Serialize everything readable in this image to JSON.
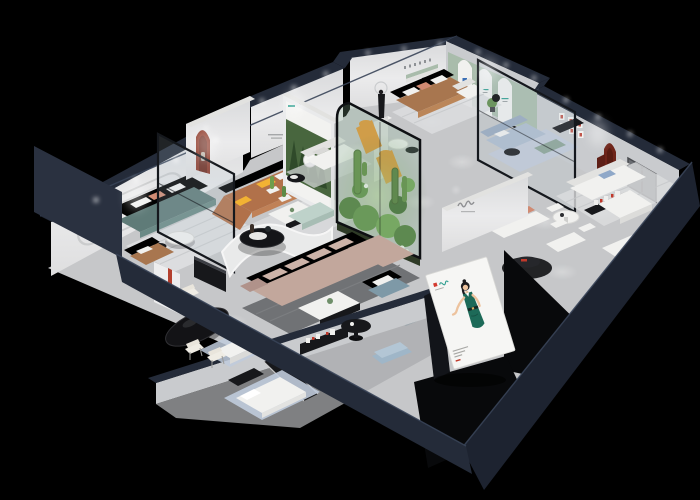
{
  "scene": {
    "kind": "isometric-cutaway-3d-floorplan",
    "subject": "furniture showroom dollhouse render on black background"
  },
  "palette": {
    "bg": "#000000",
    "navy": "#242b39",
    "navy2": "#1d2330",
    "navy3": "#2a3140",
    "face": "#e9eaeb",
    "faceShade": "#c9cbce",
    "floor": "#c6c7c9",
    "floorDark": "#a9abae",
    "rugLight": "#dcdddf",
    "rugDark": "#707275",
    "rugBlue": "#c0cbdc",
    "teal": "#5f7b78",
    "tealD": "#4f6a67",
    "cognac": "#b1714a",
    "cognacD": "#97593a",
    "leather": "#a8764f",
    "leatherD": "#8d6140",
    "rose": "#c2a79c",
    "roseD": "#b0928a",
    "white": "#f1f1ef",
    "whiteDim": "#e2e2e0",
    "bluegray": "#7e99a7",
    "bluegrayD": "#6f8fa0",
    "lightblue": "#aebccf",
    "orange": "#e8952f",
    "yellow": "#f2b233",
    "mint": "#bed2ca",
    "sage": "#a9bcab",
    "plant": "#5c8a46",
    "plantD": "#3f6a2e",
    "terr": "#6f9e4e",
    "blackF": "#17181b",
    "archRed": "#8e3a2a",
    "archDarkRed": "#6e2419",
    "redAccent": "#c0392b",
    "coral": "#d08a72",
    "glass": "rgba(185,202,212,0.18)",
    "glassGreen": "rgba(140,180,150,0.26)",
    "bbWhite": "#f6f6f4",
    "dress": "#1d6a58",
    "skin": "#edc39e",
    "hair": "#1c1b1e",
    "logoTeal": "#2e9e8f",
    "logoRed": "#d33a2f"
  },
  "rooms": [
    {
      "id": "lounge-teal",
      "items": [
        "wall-moldings",
        "potted-plant",
        "teal-sofa",
        "striped-rug",
        "round-coffee-table",
        "leather-armchair"
      ]
    },
    {
      "id": "living-cognac",
      "items": [
        "red-arch-niche",
        "cognac-sectional",
        "white-coffee-table",
        "glass-partition"
      ]
    },
    {
      "id": "gallery-poster",
      "items": [
        "forest-poster-wall",
        "white-loveseat",
        "black-side-table",
        "cactus-planters"
      ]
    },
    {
      "id": "lounge-sculpture",
      "items": [
        "figure-sculpture",
        "orange-chaise-pair",
        "dark-wall-panel"
      ]
    },
    {
      "id": "display-arches",
      "items": [
        "sage-green-wall",
        "white-arch-panels",
        "leather-sofa",
        "white-armchair",
        "nesting-tables",
        "glass-partition",
        "light-blue-sofa",
        "green-bench",
        "black-console"
      ]
    },
    {
      "id": "living-white",
      "items": [
        "red-frame-grid",
        "dark-red-arch-niche",
        "window-panel",
        "white-sectional",
        "dining-set",
        "media-shelf",
        "red-column",
        "coral-cushion-sofa",
        "white-bench",
        "black-round-rug",
        "white-cabinet"
      ]
    },
    {
      "id": "center-hall",
      "items": [
        "curved-partition",
        "black-round-table",
        "mint-bench",
        "rose-sectional",
        "dark-rug",
        "white-coffee-table"
      ]
    },
    {
      "id": "blue-seating",
      "items": [
        "blue-armchair-pair",
        "black-pedestal-table",
        "blue-ottoman"
      ]
    },
    {
      "id": "atrium",
      "items": [
        "glass-enclosure",
        "cacti",
        "shrubs",
        "white-flowers"
      ]
    },
    {
      "id": "dining-black",
      "items": [
        "black-oval-table",
        "cream-chairs",
        "red-hall-stand",
        "black-sideboard"
      ]
    },
    {
      "id": "bedroom-corner",
      "items": [
        "white-bed",
        "light-blue-rugs",
        "black-bench",
        "long-media-bench",
        "white-side-table"
      ]
    },
    {
      "id": "entrance-corridor",
      "items": [
        "brand-billboard",
        "media-console",
        "rail-wall"
      ]
    }
  ],
  "billboard": {
    "figure": "illustrated woman in green dress",
    "logo_colors": [
      "#d33a2f",
      "#2e9e8f"
    ],
    "panel_color": "#f6f6f4"
  },
  "signage": [
    {
      "name": "wall-script-logo",
      "style": "small gray cursive brand mark on hallway wall"
    },
    {
      "name": "arch-panel-logos",
      "style": "tiny blue and teal marks on arched display panels"
    },
    {
      "name": "red-frame-grid",
      "count": 6
    },
    {
      "name": "media-shelf-red-marks",
      "count": 4
    }
  ],
  "lighting": {
    "spotlights": "warm white downlights along cut wall tops and floor pools"
  }
}
